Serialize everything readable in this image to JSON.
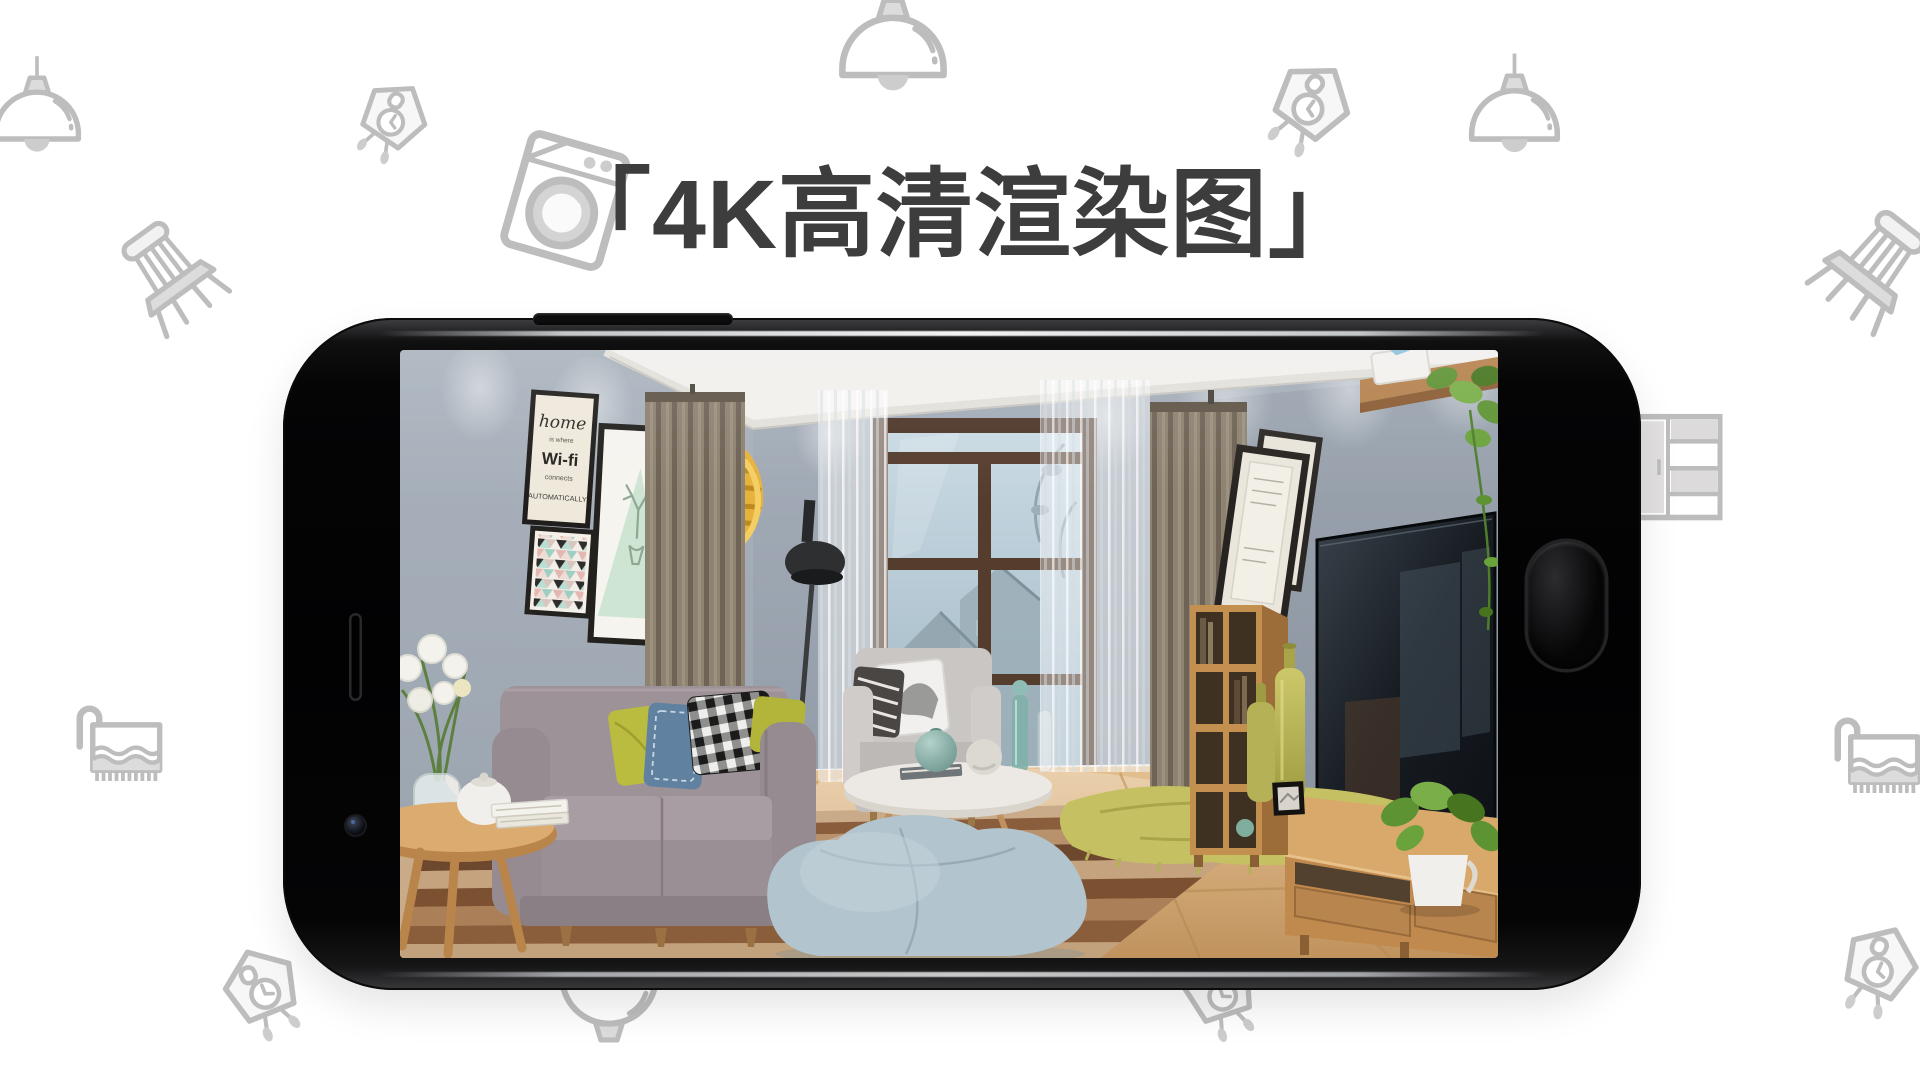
{
  "title": {
    "text": "「4K高清渲染图」",
    "color": "#3d3d3d"
  },
  "scene": {
    "wifi_poster": {
      "lines": [
        "home",
        "is where",
        "Wi-fi",
        "connects",
        "AUTOMATICALLY"
      ]
    },
    "wall_color": "#95a0ac",
    "floor_color": "#d3a873",
    "sofa_color": "#9b9095",
    "pillow_colors": [
      "#b9bc3e",
      "#60819f",
      "#161616",
      "#b2b53a"
    ],
    "curtain_color": "#8e8271",
    "beanbag_color": "#b2c4ce",
    "wood_color": "#c08a4e",
    "tv_color": "#161b20"
  },
  "background_icons": [
    "pendant-lamp",
    "cuckoo-clock",
    "chair",
    "washing-machine",
    "towel-rack",
    "drawer-cabinet"
  ],
  "phone": {
    "style": "black landscape smartphone",
    "body_color": "#050506"
  }
}
